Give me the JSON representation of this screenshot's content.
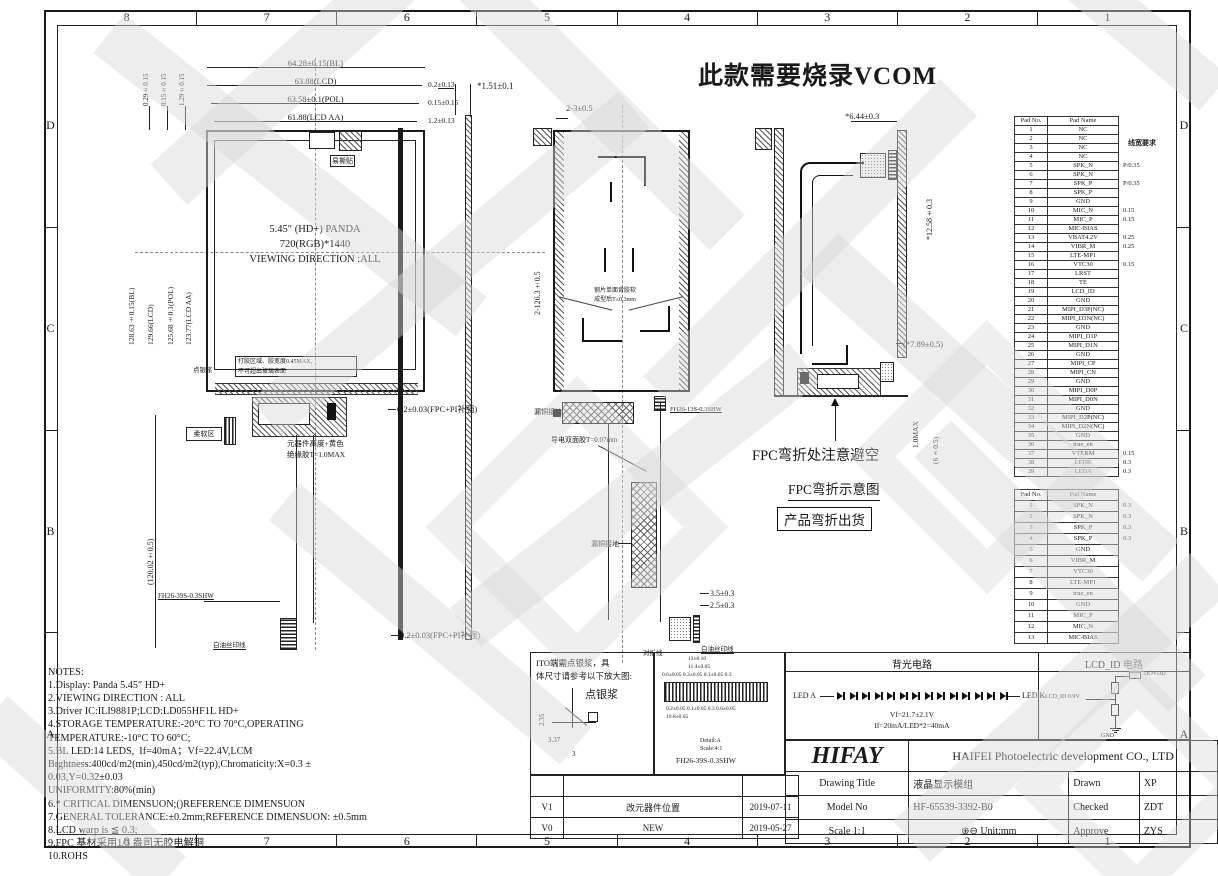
{
  "banner": "此款需要烧录VCOM",
  "zones": {
    "cols": [
      "8",
      "7",
      "6",
      "5",
      "4",
      "3",
      "2",
      "1"
    ],
    "rows": [
      "D",
      "C",
      "B",
      "A"
    ]
  },
  "front": {
    "dim_bl": "64.28±0.15(BL)",
    "dim_lcd": "63.88(LCD)",
    "dim_pol": "63.58±0.1(POL)",
    "dim_aa": "61.88(LCD AA)",
    "off1": "0.2±0.13",
    "off2": "0.15±0.15",
    "off3": "1.2±0.13",
    "loff1": "0.29±0.15",
    "loff2": "0.15±0.15",
    "loff3": "1.29±0.15",
    "vdim_bl": "128.63±0.15(BL)",
    "vdim_lcd": "129.66(LCD)",
    "vdim_pol": "125.68±0.1(POL)",
    "vdim_aa": "123.77(LCD AA)",
    "fpc_len": "(120.02±0.5)",
    "line1": "5.45″ (HD+) PANDA",
    "line2": "720(RGB)*1440",
    "line3": "VIEWING DIRECTION :ALL",
    "easy_tear": "易撕贴",
    "silver": "点银浆",
    "glue1": "打胶区域、胶宽度0.45MAX,",
    "glue2": "不可超出玻璃表面",
    "comp1": "元器件高度+黄色",
    "comp2": "绝缘胶T=1.0MAX",
    "soft": "柔软区",
    "conn": "FH26-39S-0.3SHW",
    "silk": "白油丝印线"
  },
  "side": {
    "dim_t": "*1.51±0.1",
    "fpc1": "0.2±0.03(FPC+PI补强)",
    "fpc2": "0.2±0.03(FPC+PI补强)"
  },
  "back": {
    "dim_top": "2-3±0.5",
    "dim_left": "2-126.3±0.5",
    "steel1": "钢片单面背胶软",
    "steel2": "成型后T≤0.3mm",
    "gnd1": "漏铜接地",
    "gnd2": "漏铜接地",
    "tape": "导电双面胶T=0.07mm",
    "conn": "FH26-13S-0.3SHW",
    "d35": "3.5±0.3",
    "d25": "2.5±0.3",
    "fold": "对折线",
    "silk": "白油丝印线"
  },
  "fold": {
    "d644": "*6.44±0.3",
    "d1258": "*12.58±0.3",
    "d789": "(*7.89±0.5)",
    "d10": "1.0MAX",
    "d6": "(6±0.5)",
    "cap1": "FPC弯折处注意避空",
    "cap2": "FPC弯折示意图",
    "cap3": "产品弯折出货"
  },
  "pins39": {
    "h1": "Pad No.",
    "h2": "Pad Name",
    "note": "线宽要求",
    "rows": [
      {
        "no": "1",
        "name": "NC",
        "ann": ""
      },
      {
        "no": "2",
        "name": "NC",
        "ann": ""
      },
      {
        "no": "3",
        "name": "NC",
        "ann": ""
      },
      {
        "no": "4",
        "name": "NC",
        "ann": ""
      },
      {
        "no": "5",
        "name": "SPK_N",
        "ann": "P/0.35"
      },
      {
        "no": "6",
        "name": "SPK_N",
        "ann": ""
      },
      {
        "no": "7",
        "name": "SPK_P",
        "ann": "P/0.35"
      },
      {
        "no": "8",
        "name": "SPK_P",
        "ann": ""
      },
      {
        "no": "9",
        "name": "GND",
        "ann": ""
      },
      {
        "no": "10",
        "name": "MIC_N",
        "ann": "0.15"
      },
      {
        "no": "11",
        "name": "MIC_P",
        "ann": "0.15"
      },
      {
        "no": "12",
        "name": "MIC-BIAS",
        "ann": ""
      },
      {
        "no": "13",
        "name": "VBAT4.2V",
        "ann": "0.25"
      },
      {
        "no": "14",
        "name": "VIBR_M",
        "ann": "0.25"
      },
      {
        "no": "15",
        "name": "LTE-MP1",
        "ann": ""
      },
      {
        "no": "16",
        "name": "VTC30",
        "ann": "0.15"
      },
      {
        "no": "17",
        "name": "LRST",
        "ann": ""
      },
      {
        "no": "18",
        "name": "TE",
        "ann": ""
      },
      {
        "no": "19",
        "name": "LCD_ID",
        "ann": ""
      },
      {
        "no": "20",
        "name": "GND",
        "ann": ""
      },
      {
        "no": "21",
        "name": "MIPI_D3P(NC)",
        "ann": ""
      },
      {
        "no": "22",
        "name": "MIPI_D3N(NC)",
        "ann": ""
      },
      {
        "no": "23",
        "name": "GND",
        "ann": ""
      },
      {
        "no": "24",
        "name": "MIPI_D1P",
        "ann": ""
      },
      {
        "no": "25",
        "name": "MIPI_D1N",
        "ann": ""
      },
      {
        "no": "26",
        "name": "GND",
        "ann": ""
      },
      {
        "no": "27",
        "name": "MIPI_CP",
        "ann": ""
      },
      {
        "no": "28",
        "name": "MIPI_CN",
        "ann": ""
      },
      {
        "no": "29",
        "name": "GND",
        "ann": ""
      },
      {
        "no": "30",
        "name": "MIPI_D0P",
        "ann": ""
      },
      {
        "no": "31",
        "name": "MIPI_D0N",
        "ann": ""
      },
      {
        "no": "32",
        "name": "GND",
        "ann": ""
      },
      {
        "no": "33",
        "name": "MIPI_D2P(NC)",
        "ann": ""
      },
      {
        "no": "34",
        "name": "MIPI_D2N(NC)",
        "ann": ""
      },
      {
        "no": "35",
        "name": "GND",
        "ann": ""
      },
      {
        "no": "36",
        "name": "true_en",
        "ann": ""
      },
      {
        "no": "37",
        "name": "VTERM",
        "ann": "0.15"
      },
      {
        "no": "38",
        "name": "LEDK",
        "ann": "0.3"
      },
      {
        "no": "39",
        "name": "LEDA",
        "ann": "0.3"
      }
    ]
  },
  "pins13": {
    "h1": "Pad No.",
    "h2": "Pad Name",
    "rows": [
      {
        "no": "1",
        "name": "SPK_N",
        "ann": "0.3"
      },
      {
        "no": "2",
        "name": "SPK_N",
        "ann": "0.3"
      },
      {
        "no": "3",
        "name": "SPK_P",
        "ann": "0.3"
      },
      {
        "no": "4",
        "name": "SPK_P",
        "ann": "0.3"
      },
      {
        "no": "5",
        "name": "GND",
        "ann": ""
      },
      {
        "no": "6",
        "name": "VIBR_M",
        "ann": ""
      },
      {
        "no": "7",
        "name": "VTC30",
        "ann": ""
      },
      {
        "no": "8",
        "name": "LTE-MP1",
        "ann": ""
      },
      {
        "no": "9",
        "name": "true_en",
        "ann": ""
      },
      {
        "no": "10",
        "name": "GND",
        "ann": ""
      },
      {
        "no": "11",
        "name": "MIC_P",
        "ann": ""
      },
      {
        "no": "12",
        "name": "MIC_N",
        "ann": ""
      },
      {
        "no": "13",
        "name": "MIC-BIAS",
        "ann": ""
      }
    ]
  },
  "notes_lines": [
    "NOTES:",
    "1.Display: Panda 5.45″ HD+",
    "2.VIEWING DIRECTION : ALL",
    "3.Driver IC:ILI9881P;LCD:LD055HF1L HD+",
    "4.STORAGE TEMPERATURE:-20°C TO 70°C,OPERATING",
    "TEMPERATURE:-10°C TO 60°C;",
    "5.BL LED:14 LEDS,  If=40mA；Vf=22.4V,LCM",
    "Brghtness:400cd/m2(min),450cd/m2(typ),Chromaticity:X=0.3 ±",
    "0.03,Y=0.32±0.03",
    "UNIFORMITY:80%(min)",
    "6.* CRITICAL DIMENSUON;()REFERENCE DIMENSUON",
    "7.GENERAL TOLERANCE:±0.2mm;REFERENCE DIMENSUON: ±0.5mm",
    "8.LCD warp is ≦ 0.3;",
    "9.FPC 基材采用1/3 盎司无胶电解铜",
    "10.ROHS"
  ],
  "ito": {
    "t1": "ITO端需点银浆，具",
    "t2": "体尺寸请参考以下放大图:",
    "lbl": "点银浆",
    "d1": "2.35",
    "d2": "3.37",
    "d3": "3"
  },
  "detail": {
    "top1": "12±0.10",
    "top2": "11.4±0.05",
    "top3": "0.6±0.05  0.3±0.05  0.1±0.05  0.3",
    "bot1": "0.2±0.05  0.1±0.05  0.3  0.6±0.05",
    "bot2": "10.8±0.05",
    "cap1": "Detail:A",
    "cap2": "Scale:4:1",
    "cap3": "FH26-39S-0.3SHW"
  },
  "rev": {
    "rows": [
      {
        "v": "V1",
        "d": "改元器件位置",
        "t": "2019-07-11"
      },
      {
        "v": "V0",
        "d": "NEW",
        "t": "2019-05-27"
      }
    ]
  },
  "bl_circuit": {
    "title": "背光电路",
    "a": "LED A",
    "k": "LED K",
    "vf": "Vf=21.7±2.1V",
    "if": "If=20mA/LED*2=40mA",
    "leds": [
      1,
      1,
      1,
      1,
      1,
      1,
      1,
      1,
      1,
      1,
      1,
      1,
      1,
      1
    ]
  },
  "id_circuit": {
    "title": "LCD_ID 电路",
    "vdd": "DOVDD",
    "sig": "LCD_ID 0.9V",
    "gnd": "GND"
  },
  "tb": {
    "logo": "HIFAY",
    "company": "HAIFEI Photoelectric development CO., LTD",
    "r1l": "Drawing Title",
    "r1v": "液晶显示模组",
    "r1l2": "Drawn",
    "r1v2": "XP",
    "r2l": "Model No",
    "r2v": "HF-65539-3392-B0",
    "r2l2": "Checked",
    "r2v2": "ZDT",
    "r3l": "Scale 1:1",
    "r3v": "⊕⊖ Unit:mm",
    "r3l2": "Approve",
    "r3v2": "ZYS"
  }
}
